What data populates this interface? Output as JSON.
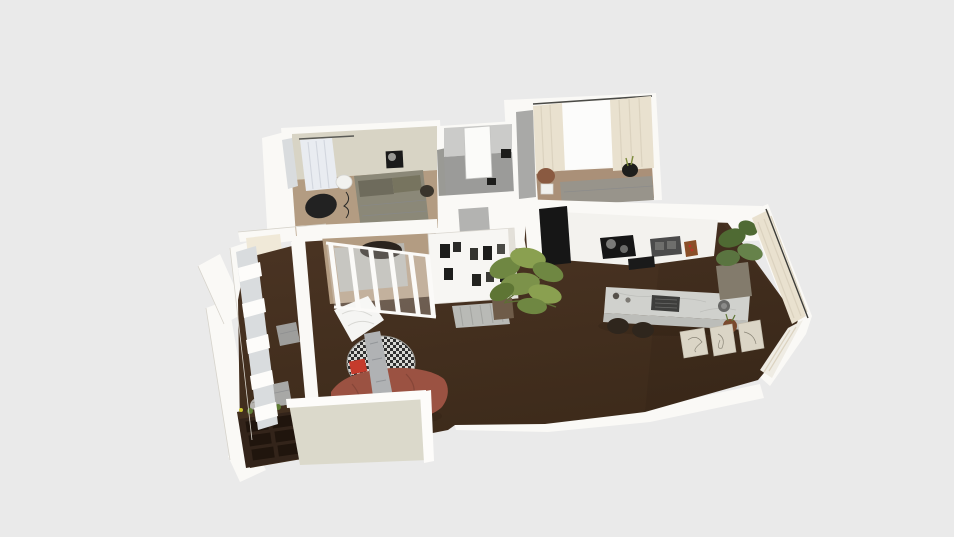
{
  "scene": {
    "description": "3D aerial render of an L-shaped apartment floor plan on a plain light gray background, no UI chrome visible",
    "background": "#eaeaea",
    "colors": {
      "wall": "#faf9f6",
      "wall_shade": "#e6e3db",
      "south_wall": "#dbd9cb",
      "cream_wall": "#f0e9d8",
      "bedroom_wall": "#d8d4c5",
      "bath_wall": "#cbcbc9",
      "bath_floor": "#9b9b99",
      "floor_dark": "#46301f",
      "floor_wood": "#b39c82",
      "floor_wood_b": "#aa9078",
      "nook_rug": "#b8b6b0",
      "glass": "#d9dcde",
      "window_glow": "#fcfcfb",
      "curtain_cream": "#e9e1cf",
      "curtain_white": "#e9ecf1",
      "gray_wall_face": "#a9a9a7",
      "counter": "#f3f2ee",
      "island_top": "#d0d1cd",
      "island_side": "#bcbdb9",
      "appliance_black": "#161616",
      "sink_gray": "#4b4b4b",
      "board_wood": "#8a4f28",
      "sofa": "#9b5242",
      "sofa_shadow": "#7d4134",
      "blanket_gray": "#b0b2b4",
      "rug_light": "#d9d9d5",
      "rug_dark": "#303030",
      "pillow_red": "#c53b2c",
      "sheet_white": "#f5f5f3",
      "plant_green": "#6f8742",
      "plant_dark": "#4f6a33",
      "plant_light": "#8aa050",
      "planter_gray": "#837b6c",
      "pot_brown": "#6f5c49",
      "pot_terra": "#7a4a2e",
      "dresser": "#33241a",
      "drawer_dark": "#20150d",
      "pouf_gray": "#9e9e9c",
      "bed_gray": "#8b8878",
      "bed_pillow": "#6e6b5c",
      "bed_gray_b": "#98948b",
      "chair_black": "#222222",
      "chair_terra": "#8a5a41",
      "frame_beige": "#dbd5c6",
      "metal_gray": "#b9bab6",
      "art_dark": "#1a1a1a",
      "art_gray": "#b3b3b1"
    },
    "objects": [
      "bedroom-bed",
      "bedroom-curtain",
      "desk-chair",
      "wall-art",
      "side-table",
      "shower-panel",
      "bedroom-b-bed",
      "bedroom-b-curtains",
      "accent-chair",
      "plant-pot",
      "kitchen-counter",
      "cooktop",
      "kitchen-sink",
      "cutting-board",
      "fridge-door",
      "kitchen-island",
      "island-sink",
      "bar-stool",
      "indoor-plant",
      "tall-planter",
      "bookshelf",
      "radiator-bench",
      "picture-frames",
      "round-rug",
      "red-pillow",
      "coffee-cup",
      "gray-blanket",
      "terracotta-sofa",
      "floor-sheet",
      "floor-pouf",
      "decor-sphere",
      "dresser",
      "window-wall",
      "curtain-wall",
      "sliding-partition"
    ]
  }
}
